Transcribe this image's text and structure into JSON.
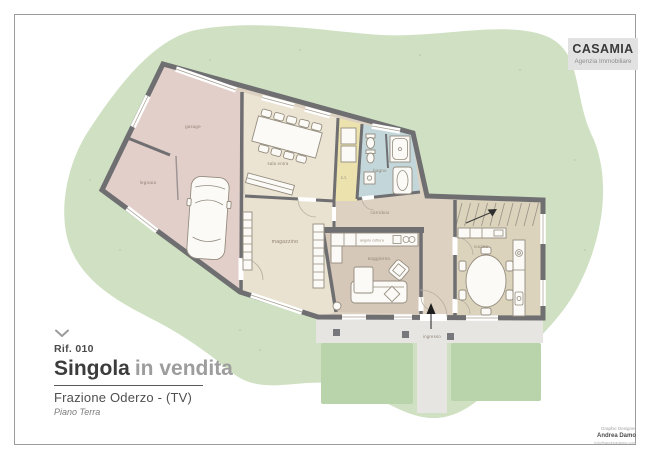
{
  "logo": {
    "name": "CASAMIA",
    "subtitle": "Agenzia Immobiliare"
  },
  "listing": {
    "ref": "Rif. 010",
    "title_main": "Singola",
    "title_sub": "in vendita",
    "location": "Frazione Oderzo - (TV)",
    "floor": "Piano Terra"
  },
  "credits": {
    "role": "Graphic Designer",
    "name": "Andrea Damo",
    "contact": "info@andreadamo.com"
  },
  "plan": {
    "rooms": [
      {
        "id": "garage",
        "label": "garage"
      },
      {
        "id": "legnaia",
        "label": "legnaia"
      },
      {
        "id": "sala",
        "label": "sala entra"
      },
      {
        "id": "magazzino",
        "label": "magazzino"
      },
      {
        "id": "ct",
        "label": "c.t."
      },
      {
        "id": "bagno",
        "label": "bagno"
      },
      {
        "id": "corridoio",
        "label": "corridoio"
      },
      {
        "id": "soggiorno",
        "label": "soggiorno"
      },
      {
        "id": "angolo-cottura",
        "label": "angolo cottura"
      },
      {
        "id": "cucina",
        "label": "cucina"
      },
      {
        "id": "ingresso",
        "label": "ingresso"
      }
    ]
  },
  "colors": {
    "garden_green": "#cfe1c2",
    "lawn_green": "#b9d4aa",
    "wing_pink": "#e3cfca",
    "room_beige": "#ece4d3",
    "corridor_beige": "#ddd2c2",
    "living_taupe": "#d6c8b9",
    "kitchen_khaki": "#dbd3bb",
    "boiler_yellow": "#ebe2ae",
    "bath_blue": "#c3d7da",
    "wall_gray": "#6f6f72",
    "logo_bg": "#e2e2e2",
    "accent_text": "#3c3c3c",
    "muted_text": "#9d9d9d"
  }
}
